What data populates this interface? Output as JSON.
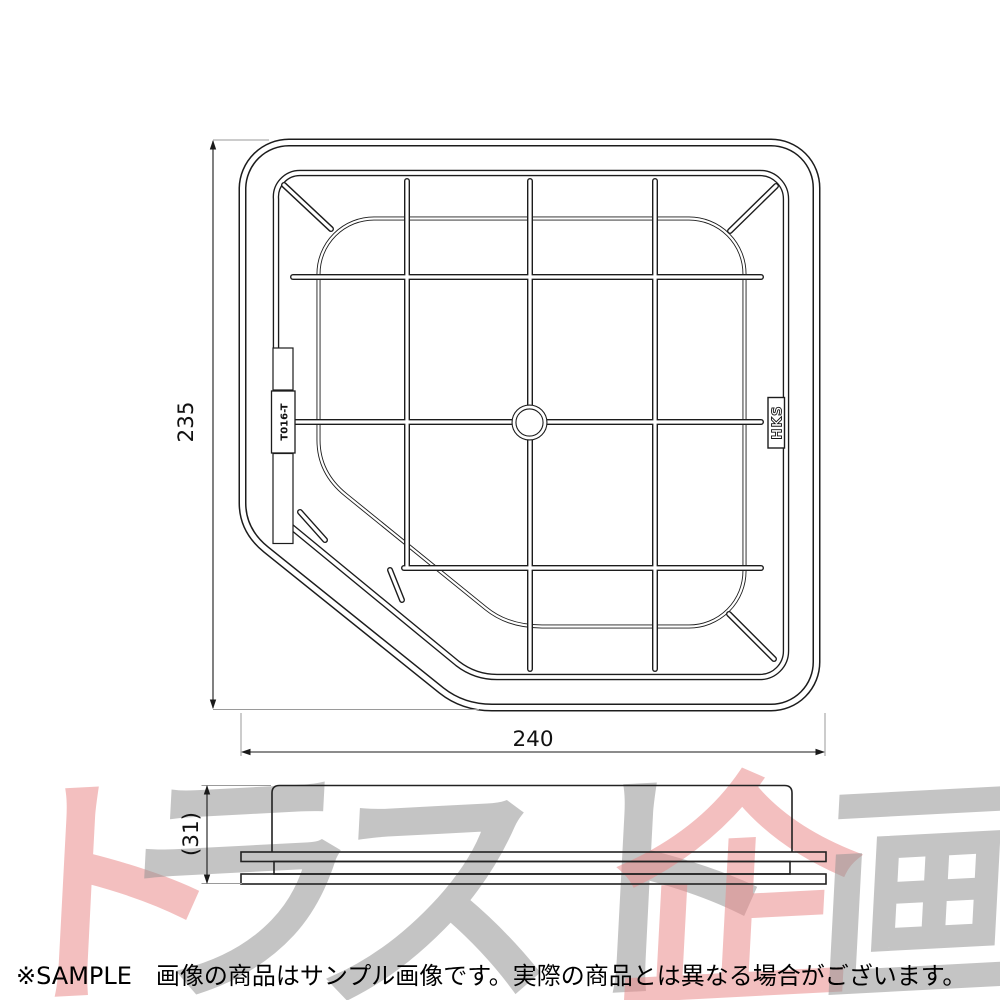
{
  "image_type": "air-filter technical drawing product photo",
  "top_view": {
    "width_dim": "240",
    "height_dim": "235",
    "brand_label": "HKS",
    "molded_part_label": "T016-T"
  },
  "side_view": {
    "height_dim": "(31)"
  },
  "watermark": {
    "text": "トラスト企画",
    "chars": [
      {
        "char": "ト",
        "color": "#e98a8a"
      },
      {
        "char": "ラ",
        "color": "#949494"
      },
      {
        "char": "ス",
        "color": "#949494"
      },
      {
        "char": "ト",
        "color": "#949494"
      },
      {
        "char": "企",
        "color": "#e98a8a"
      },
      {
        "char": "画",
        "color": "#949494"
      }
    ]
  },
  "caption": "※SAMPLE　画像の商品はサンプル画像です。実際の商品とは異なる場合がございます。",
  "colors": {
    "background": "#ffffff",
    "line": "#1c1c1c",
    "extension_line": "#9a9a9a",
    "watermark_gray": "#c2c2c2",
    "watermark_pink": "#f5b9b9",
    "caption_text": "#000000"
  }
}
